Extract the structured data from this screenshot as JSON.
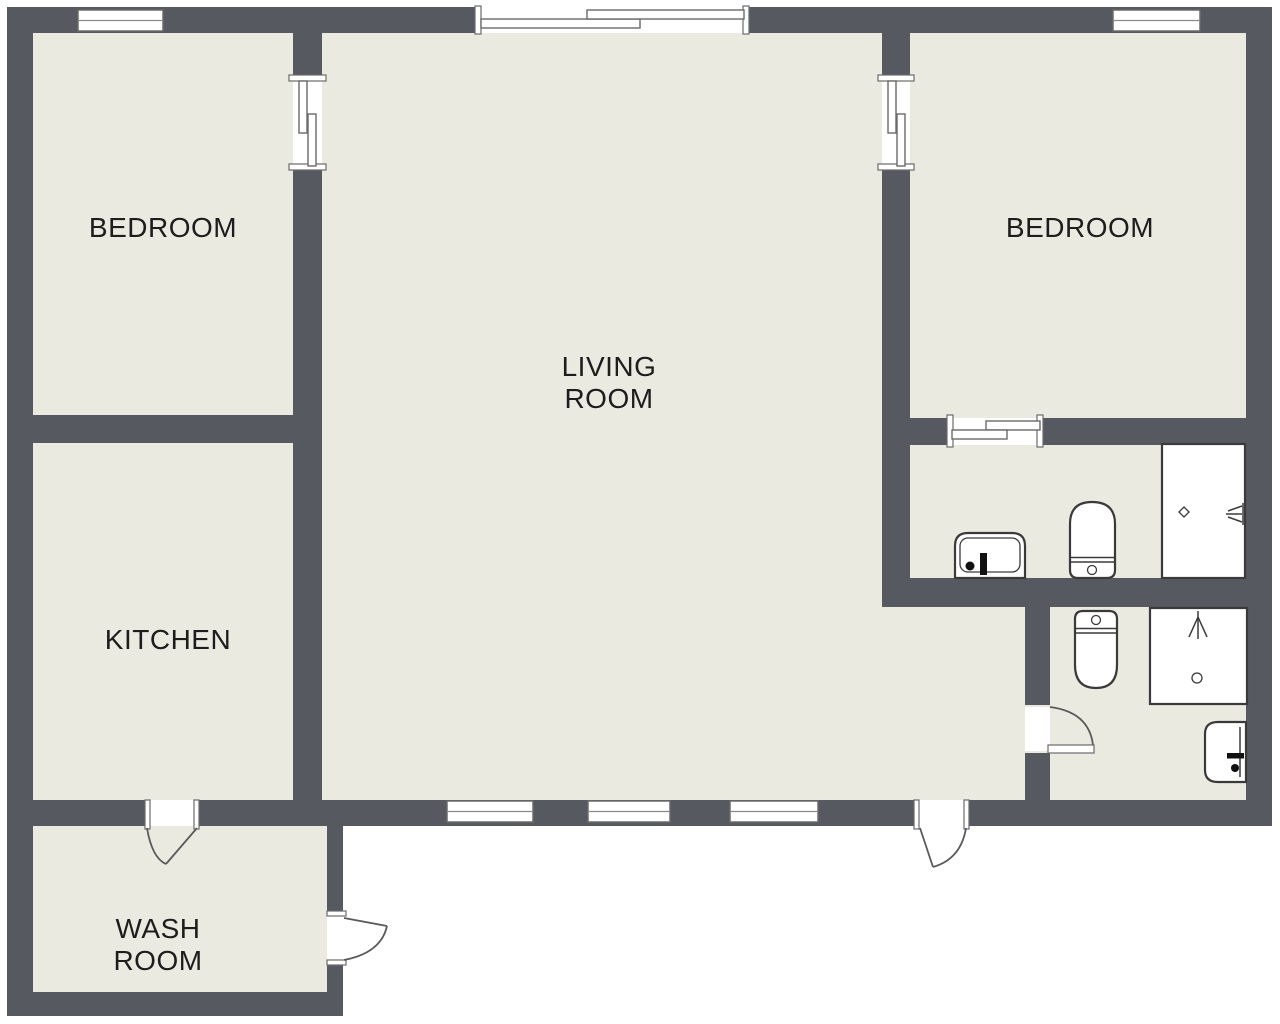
{
  "title": "Two-bedroom apartment floor plan",
  "colors": {
    "wall": "#565a60",
    "floor": "#ebeae1",
    "outline": "#6a6a6a",
    "fixture": "#3a3a3a",
    "label": "#1d1d1d",
    "door": "#5a5a5a",
    "white": "#ffffff"
  },
  "rooms": {
    "bedroom_left": {
      "label": "BEDROOM"
    },
    "bedroom_right": {
      "label": "BEDROOM"
    },
    "living_room": {
      "line1": "LIVING",
      "line2": "ROOM"
    },
    "kitchen": {
      "label": "KITCHEN"
    },
    "wash_room": {
      "line1": "WASH",
      "line2": "ROOM"
    },
    "bathroom_upper": {
      "label": ""
    },
    "bathroom_lower": {
      "label": ""
    }
  },
  "windows": [
    {
      "id": "window-top-left",
      "wall": "top"
    },
    {
      "id": "window-top-right",
      "wall": "top"
    },
    {
      "id": "window-bottom-1",
      "wall": "bottom"
    },
    {
      "id": "window-bottom-2",
      "wall": "bottom"
    },
    {
      "id": "window-bottom-3",
      "wall": "bottom"
    }
  ],
  "doors": [
    {
      "id": "sliding-door-living-top",
      "type": "sliding"
    },
    {
      "id": "sliding-door-bedroom-left",
      "type": "sliding"
    },
    {
      "id": "sliding-door-bedroom-right",
      "type": "sliding"
    },
    {
      "id": "sliding-door-bathroom-upper",
      "type": "sliding"
    },
    {
      "id": "door-kitchen-washroom",
      "type": "swing"
    },
    {
      "id": "door-washroom-exterior",
      "type": "swing"
    },
    {
      "id": "door-main-entrance",
      "type": "swing"
    },
    {
      "id": "door-bathroom-lower",
      "type": "swing"
    }
  ],
  "fixtures": {
    "bathroom_upper": [
      "sink",
      "toilet",
      "shower"
    ],
    "bathroom_lower": [
      "toilet",
      "shower",
      "sink"
    ]
  }
}
